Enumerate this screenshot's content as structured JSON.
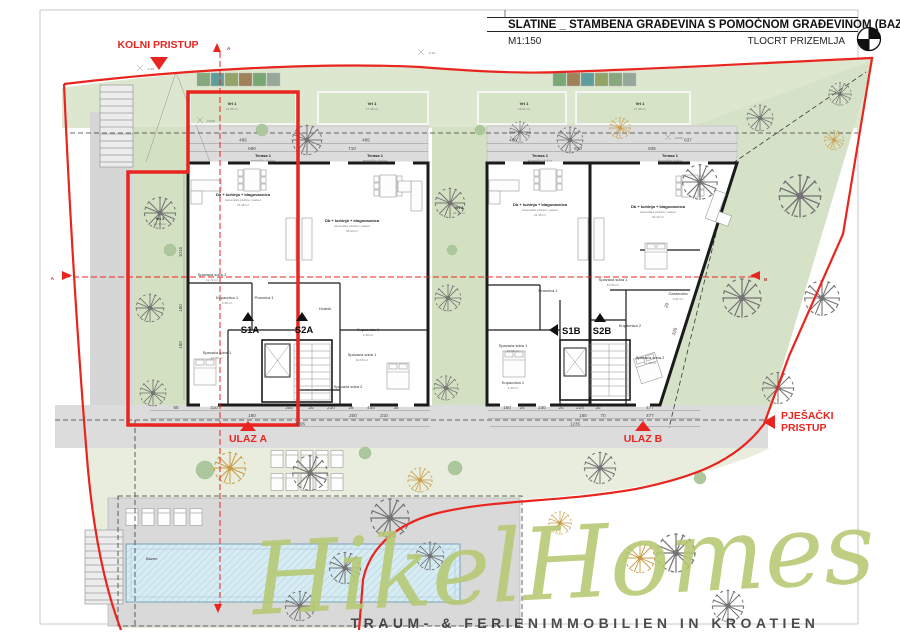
{
  "title_block": {
    "project": "SLATINE _ STAMBENA GRAĐEVINA S POMOĆNOM GRAĐEVINOM (BAZEN)",
    "scale": "M1:150",
    "drawing": "TLOCRT PRIZEMLJA"
  },
  "access": {
    "kolni": "KOLNI PRISTUP",
    "pjesacki_line1": "PJEŠAČKI",
    "pjesacki_line2": "PRISTUP",
    "ulaz_a": "ULAZ A",
    "ulaz_b": "ULAZ B"
  },
  "units": {
    "s1a": "S1A",
    "s2a": "S2A",
    "s1b": "S1B",
    "s2b": "S2B"
  },
  "sections": {
    "a": "A",
    "b": "B"
  },
  "elevations": {
    "e1": "-2.10",
    "e2": "-2.10",
    "e3": "±0.00",
    "e4": "±0.00"
  },
  "gardens": {
    "g1_name": "Vrt 1",
    "g1_area": "14.53 m²",
    "g2_name": "Vrt 1",
    "g2_area": "17.40 m²",
    "g3_name": "Vrt 1",
    "g3_area": "14.61 m²",
    "g4_name": "Vrt 1",
    "g4_area": "17.40 m²",
    "side_left_name": "Vrt 2",
    "side_left_area": "22.15 m²",
    "side_mid_name": "Vrt 2",
    "side_mid_area": "22.16 m²"
  },
  "terrace": {
    "name": "Terasa 1",
    "finish": "keramičke pločice"
  },
  "rooms": {
    "living": "Db + kuhinja + blagovaonica",
    "living_finish": "keramičke pločice i parket",
    "living_area_a": "41.45 m²",
    "living_area_b": "43.44 m²",
    "bedroom1": "Spavaća soba 1",
    "bedroom1_area": "10.50 m²",
    "bedroom2": "Spavaća soba 2",
    "bedroom2_area": "11.72 m²",
    "bath1": "Kupaonica 1",
    "bath1_area": "4.30 m²",
    "bath2": "Kupaonica 2",
    "laundry": "Praonica 1",
    "hall": "Hodnik",
    "wardrobe": "Garderoba",
    "wardrobe_area": "4.62 m²"
  },
  "pool": {
    "label": "Bazen"
  },
  "dims": {
    "terr": [
      "485",
      "690",
      "710",
      "485",
      "485",
      "610",
      "935",
      "637"
    ],
    "bl1": [
      "55",
      "310",
      "355",
      "25",
      "230",
      "25",
      "455",
      "35"
    ],
    "bl2": [
      "180",
      "200",
      "210"
    ],
    "bl_total": "1495",
    "br1": [
      "150",
      "25",
      "230",
      "25",
      "224",
      "25"
    ],
    "br2": [
      "180",
      "70",
      "477",
      "477"
    ],
    "br_total": "1235",
    "lv": [
      "1015",
      "160",
      "180"
    ],
    "slant": [
      "328",
      "29"
    ]
  },
  "watermark": {
    "brand": "HikelHomes",
    "tagline": "TRAUM- & FERIENIMMOBILIEN IN KROATIEN"
  },
  "colors": {
    "highlight_red": "#e8251f",
    "plan_green": "#dde7d0",
    "pool_blue": "#cfe6ef",
    "watermark_green": "#b6c973"
  }
}
